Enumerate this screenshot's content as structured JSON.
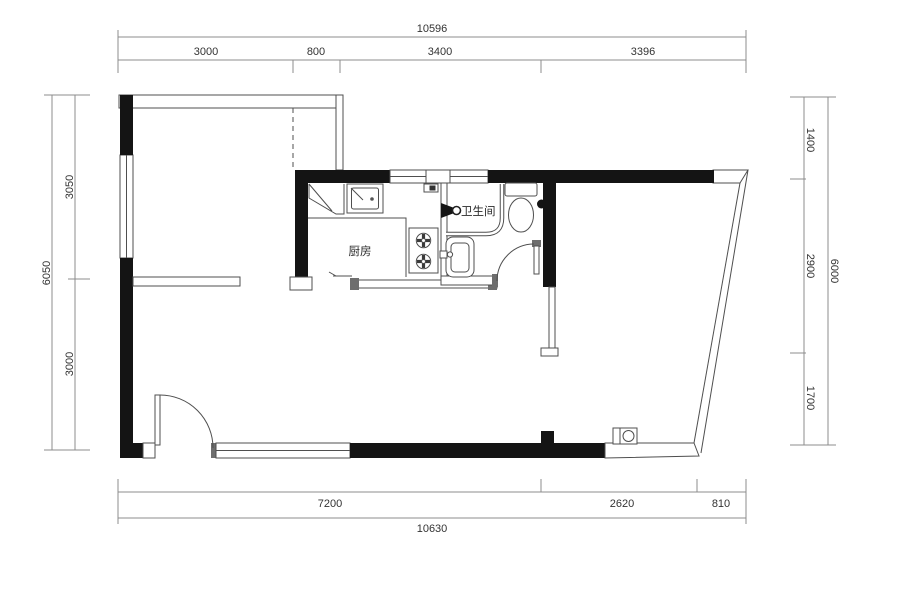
{
  "dimensions": {
    "top": {
      "overall": "10596",
      "segments": [
        "3000",
        "800",
        "3400",
        "3396"
      ]
    },
    "bottom": {
      "overall": "10630",
      "segments": [
        "7200",
        "2620",
        "810"
      ]
    },
    "left": {
      "overall": "6050",
      "segments": [
        "3050",
        "3000"
      ]
    },
    "right": {
      "overall": "6000",
      "segments": [
        "1400",
        "2900",
        "1700"
      ]
    }
  },
  "rooms": {
    "kitchen": "厨房",
    "bathroom": "卫生间"
  },
  "colors": {
    "wall": "#141414",
    "line": "#4f4f4f",
    "dim": "#8c8c8c",
    "text": "#333333",
    "bg": "#ffffff"
  }
}
